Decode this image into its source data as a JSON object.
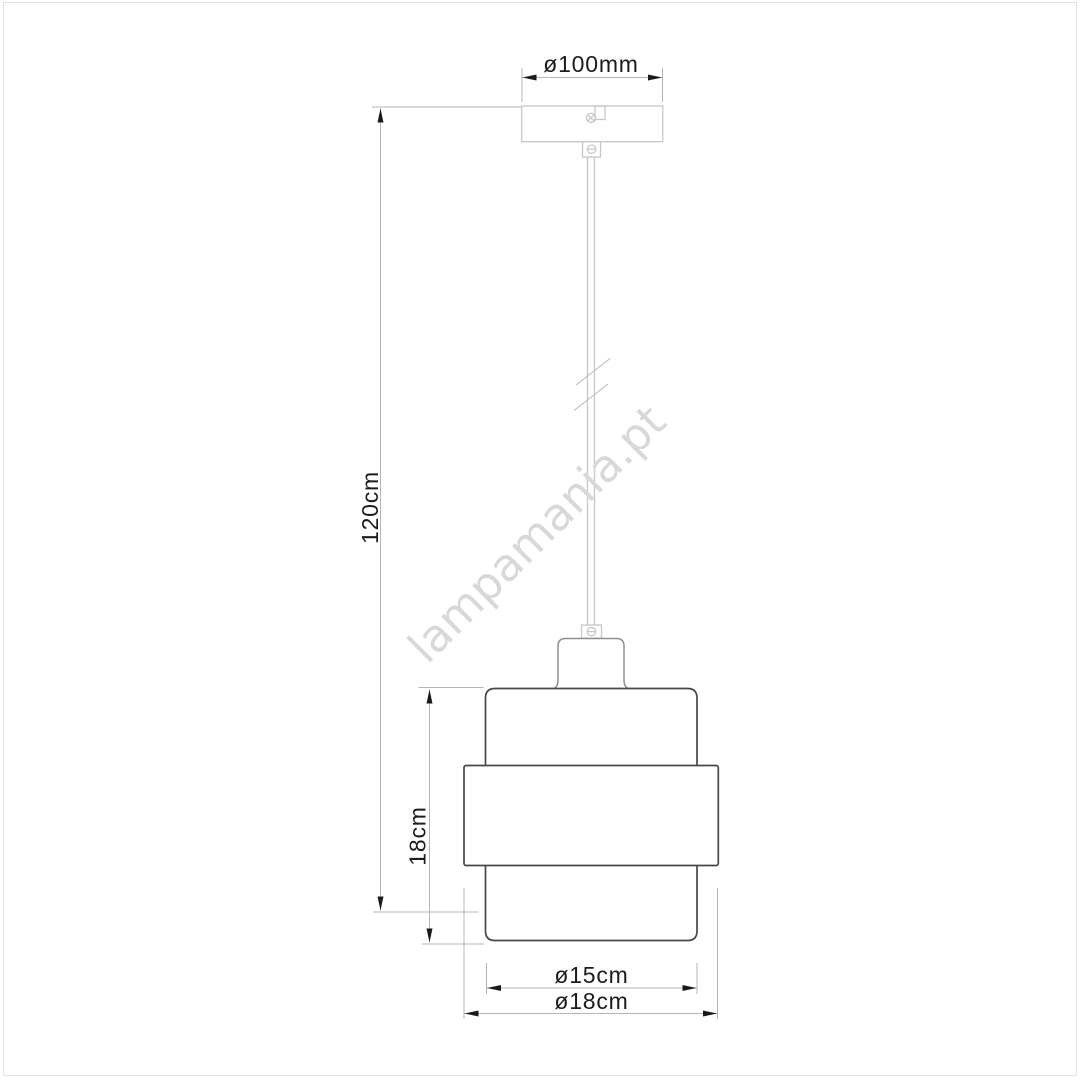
{
  "colors": {
    "background": "#ffffff",
    "frame": "#e2e2e2",
    "outline_dark": "#474747",
    "outline_medium": "#8f8f8f",
    "outline_light": "#c7c7c7",
    "dimension_line": "#b5b5b5",
    "arrow": "#1a1a1a",
    "text": "#1c1c1c",
    "watermark": "#d8d8d8"
  },
  "watermark": {
    "text": "lampamania.pt"
  },
  "diagram": {
    "product": "Pendant lamp dimension drawing",
    "labels": {
      "canopy_diameter": "ø100mm",
      "suspension_height": "120cm",
      "shade_height": "18cm",
      "shade_inner_diameter": "ø15cm",
      "shade_outer_diameter": "ø18cm"
    }
  }
}
